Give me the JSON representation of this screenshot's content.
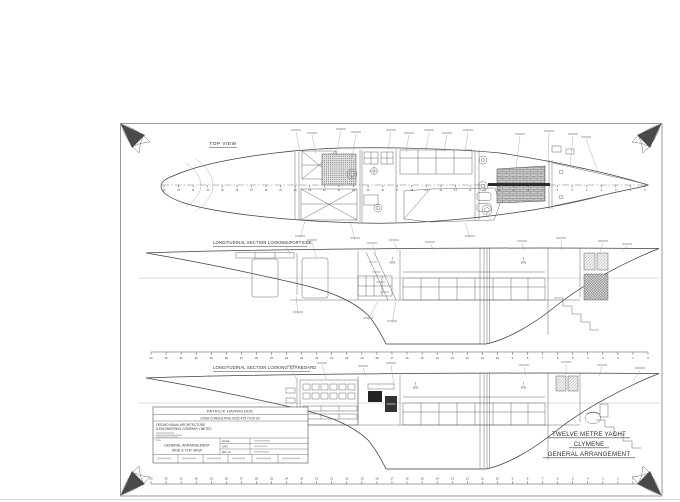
{
  "drawing": {
    "views": {
      "top_view": {
        "title": "TOP VIEW"
      },
      "portside": {
        "title": "LONGITUDINAL SECTION LOOKING PORTSIDE"
      },
      "starboard": {
        "title": "LONGITUDINAL SECTION LOOKING STARBOARD"
      }
    },
    "stamp": {
      "line1": "TWELVE METRE YACHT",
      "line2": "CLYMENE",
      "line3": "GENERAL ARRANGEMENT"
    },
    "title_block": {
      "owner": "PATRICK HARWOODE",
      "consulting": "CASA CONSULTING    0032 475 70 00 02",
      "company_line1": "ORCHID NAVAL ARCHITECTURE",
      "company_line2": "& ENGINEERING COMPANY LIMITED",
      "title_label": "TITLE",
      "drawing_title_line1": "GENERAL ARRANGEMENT",
      "drawing_title_line2": "SIDE & TOP VIEW",
      "field_labels": [
        "SCALE",
        "DATE",
        "DRG No"
      ]
    },
    "stations": [
      33,
      32,
      31,
      30,
      29,
      28,
      27,
      26,
      25,
      24,
      23,
      22,
      21,
      20,
      19,
      18,
      17,
      16,
      15,
      14,
      13,
      12,
      11,
      10,
      9,
      8,
      7,
      6,
      5,
      4,
      3,
      2,
      1,
      0
    ]
  },
  "colors": {
    "ink": "#4a4a4a",
    "paper": "#ffffff",
    "light": "#9a9a9a"
  }
}
